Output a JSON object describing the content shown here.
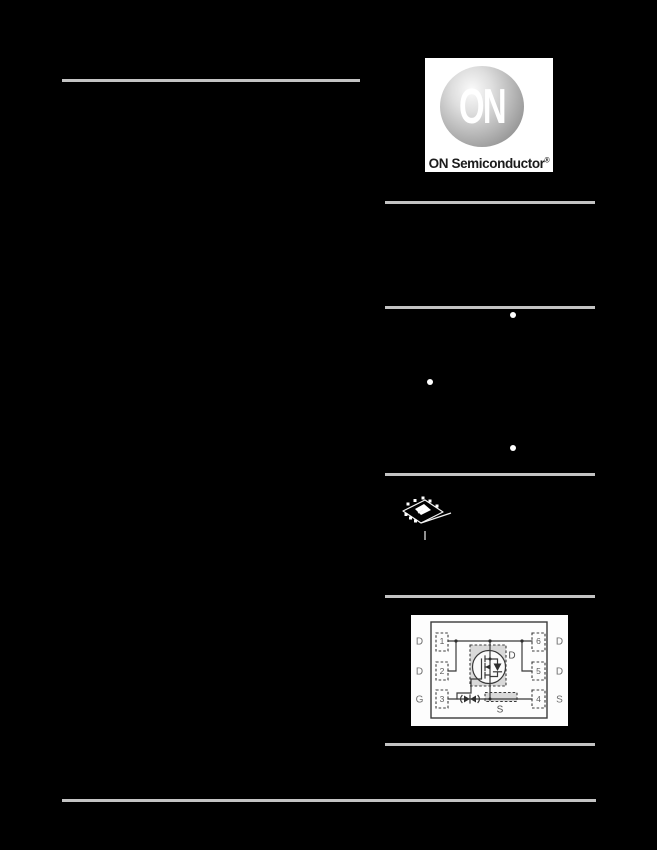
{
  "document": {
    "type": "datasheet-page"
  },
  "logo": {
    "brand": "ON",
    "caption": "ON Semiconductor",
    "registered_mark": "®"
  },
  "features": {
    "visible_bullet_count": 3
  },
  "pinout": {
    "left_pins": [
      {
        "number": "1",
        "label": "D"
      },
      {
        "number": "2",
        "label": "D"
      },
      {
        "number": "3",
        "label": "G"
      }
    ],
    "right_pins": [
      {
        "number": "6",
        "label": "D"
      },
      {
        "number": "5",
        "label": "D"
      },
      {
        "number": "4",
        "label": "S"
      }
    ],
    "internal": {
      "drain_label": "D",
      "source_label": "S"
    }
  },
  "colors": {
    "page_bg": "#000000",
    "rule": "#c3c3c3",
    "bullet": "#ffffff",
    "diagram_ink": "#3a3a3a",
    "diagram_bg": "#fdfdfd",
    "diagram_fill": "#d9d9d9"
  }
}
